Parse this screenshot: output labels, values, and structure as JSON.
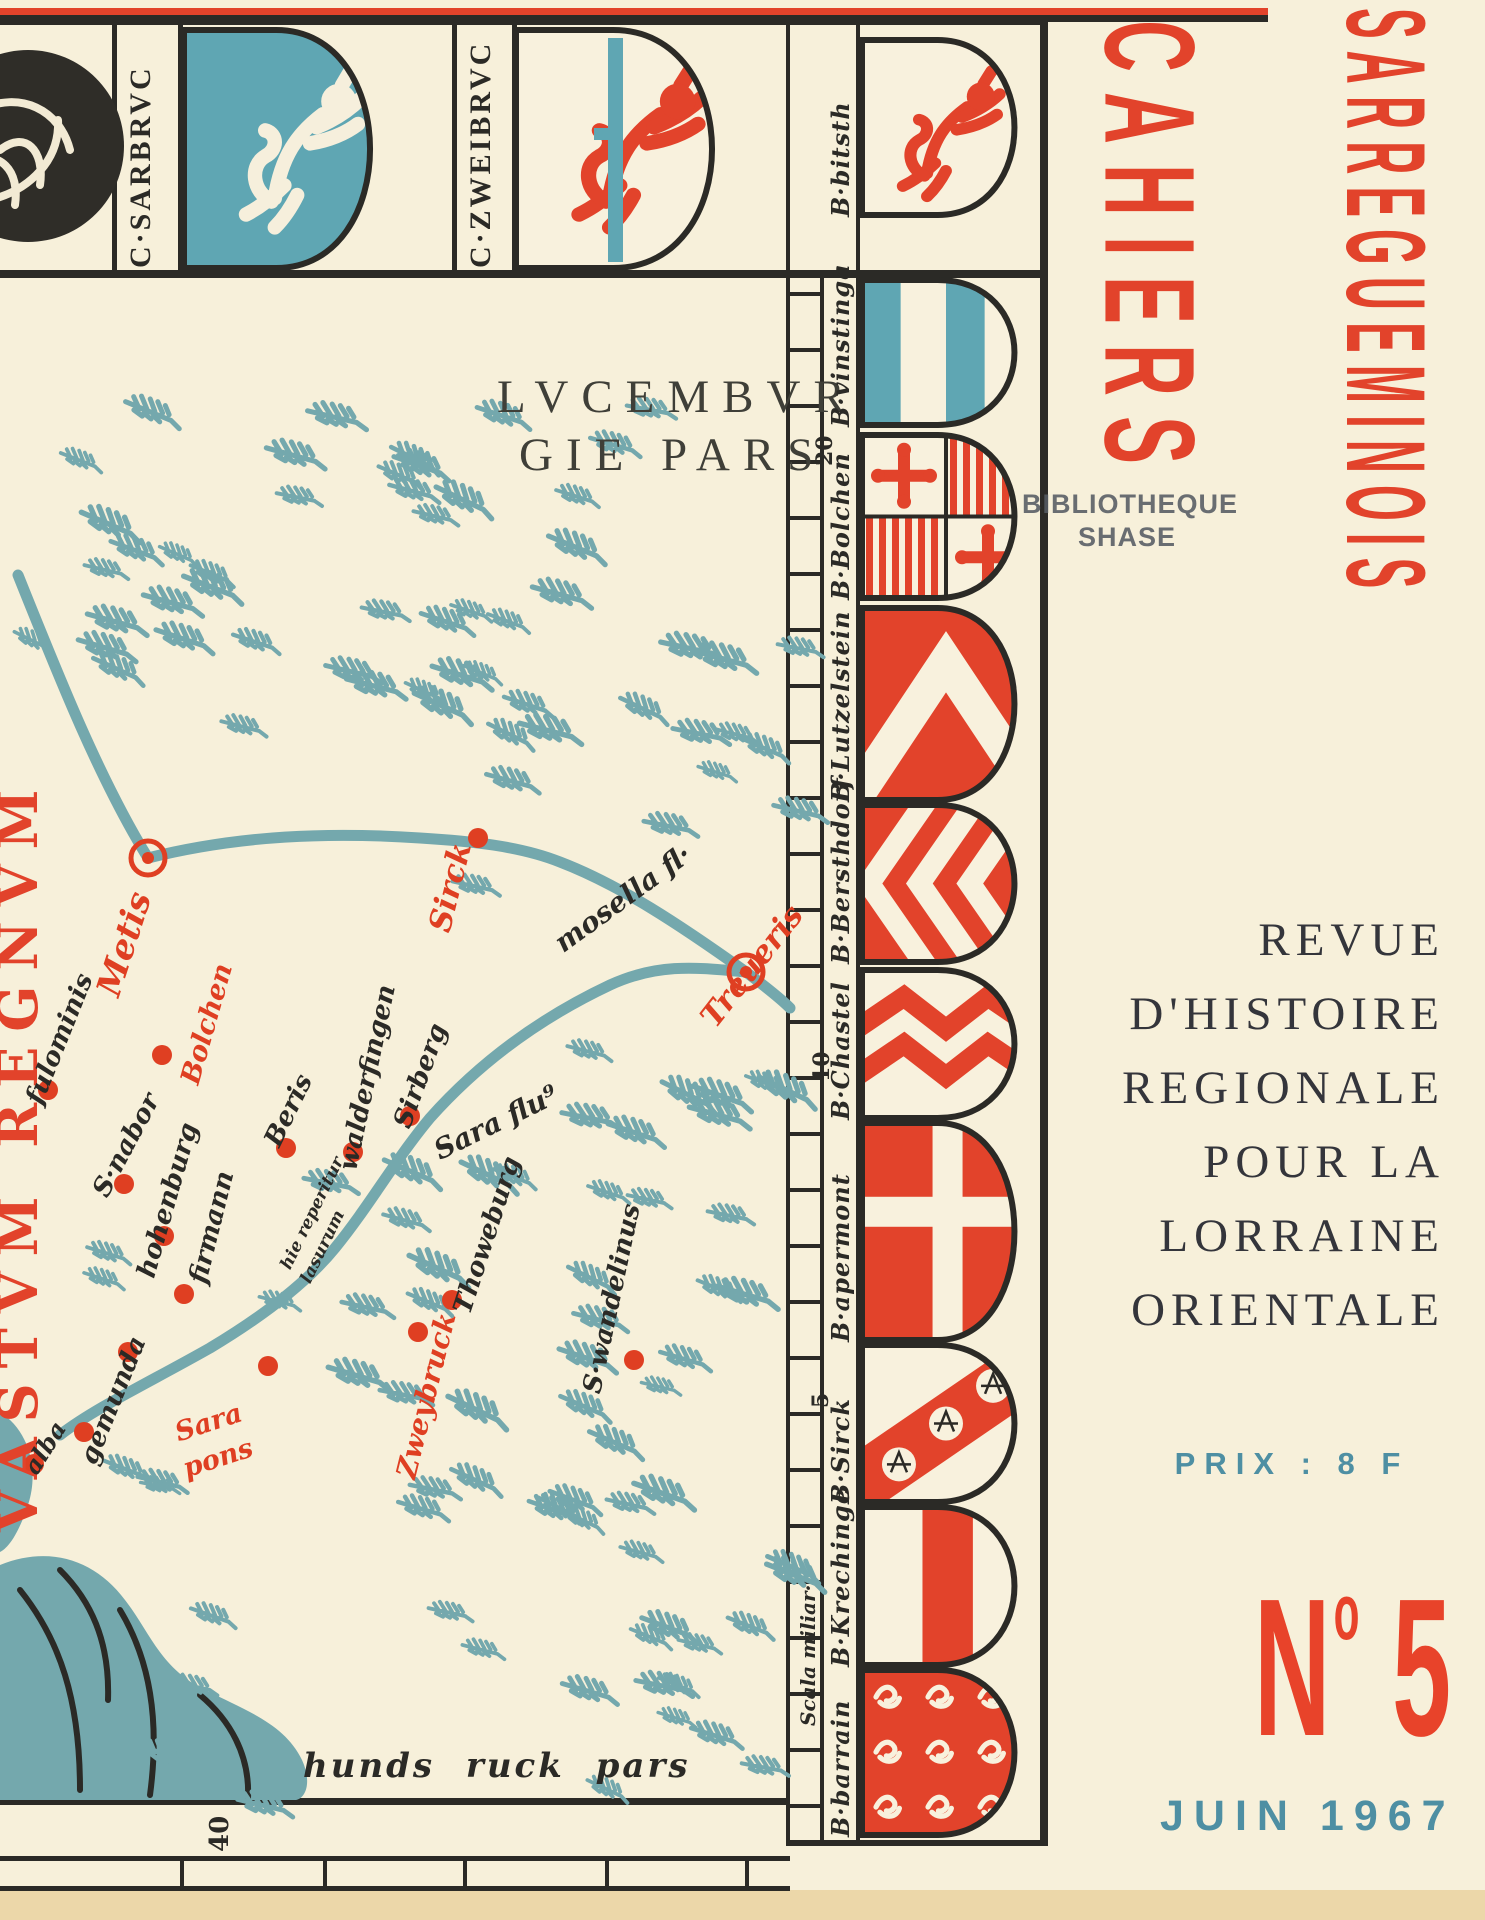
{
  "page": {
    "width": 1485,
    "height": 1920,
    "background": "#f7f0da",
    "bottom_edge_color": "#ecd7a9"
  },
  "colors": {
    "red": "#e2432b",
    "map_red": "#df3f22",
    "teal": "#74a8ad",
    "shield_teal": "#5fa6b3",
    "ink": "#2b2a26",
    "teal_text": "#4e8fa3",
    "subtitle_ink": "#34353b",
    "stamp_gray": "#565b63"
  },
  "masthead": {
    "line1": "CAHIERS",
    "line2": "SARREGUEMINOIS"
  },
  "stamp": {
    "line1": "BIBLIOTHEQUE",
    "line2": "SHASE"
  },
  "subtitle": {
    "lines": [
      "REVUE",
      "D'HISTOIRE",
      "REGIONALE",
      "POUR LA",
      "LORRAINE",
      "ORIENTALE"
    ]
  },
  "price": {
    "label": "PRIX : 8 F"
  },
  "issue": {
    "prefix": "N",
    "sup": "o",
    "number": " 5"
  },
  "date": {
    "label": "JUIN 1967"
  },
  "top_band": {
    "labels": [
      {
        "text": "C·SARBRVC",
        "x": 124,
        "y": 268
      },
      {
        "text": "C·ZWEIBRVC",
        "x": 464,
        "y": 268
      }
    ],
    "shields": [
      {
        "name": "medallion-eagle"
      },
      {
        "name": "lion-white-on-teal"
      },
      {
        "name": "lion-red-with-crozier"
      }
    ]
  },
  "strip": {
    "scale_caption": "Scala miliar·",
    "shields": [
      {
        "label": "B·bitsth",
        "pattern": "lion-red",
        "y0": 40,
        "y1": 215
      },
      {
        "label": "B·vinstinga",
        "pattern": "paly-teal",
        "y0": 280,
        "y1": 425
      },
      {
        "label": "B·Bolchen",
        "pattern": "quartered-crosses",
        "y0": 435,
        "y1": 598
      },
      {
        "label": "B·Lutzelstein",
        "pattern": "chevron-white-on-red",
        "y0": 608,
        "y1": 800
      },
      {
        "label": "B·Bersthdorf",
        "pattern": "chevrons-sideways",
        "y0": 805,
        "y1": 962
      },
      {
        "label": "B·Chastel",
        "pattern": "dancetty-red",
        "y0": 970,
        "y1": 1118
      },
      {
        "label": "B·apermont",
        "pattern": "cross-white-on-red",
        "y0": 1123,
        "y1": 1340
      },
      {
        "label": "B·Sirck",
        "pattern": "bend-scallops",
        "y0": 1345,
        "y1": 1502
      },
      {
        "label": "B·Krechinge",
        "pattern": "pale-red",
        "y0": 1507,
        "y1": 1665
      },
      {
        "label": "B·barrain",
        "pattern": "semy-lions",
        "y0": 1670,
        "y1": 1835
      }
    ]
  },
  "map": {
    "region_title": {
      "line1": "LVCEMBVR",
      "line2": "GIE PARS"
    },
    "edge_title": "VASTVM REGNVM",
    "bottom_caption": "hunds ruck pars",
    "labels": [
      {
        "text": "Metis",
        "x": 108,
        "y": 978,
        "rot": -72,
        "color": "red",
        "size": 34
      },
      {
        "text": "Bolchen",
        "x": 190,
        "y": 1070,
        "rot": -74,
        "color": "red",
        "size": 27
      },
      {
        "text": "fulominis",
        "x": 34,
        "y": 1090,
        "rot": -68,
        "color": "ink",
        "size": 26
      },
      {
        "text": "S·nabor",
        "x": 100,
        "y": 1182,
        "rot": -62,
        "color": "ink",
        "size": 26
      },
      {
        "text": "hohenburg",
        "x": 146,
        "y": 1264,
        "rot": -74,
        "color": "ink",
        "size": 26
      },
      {
        "text": "firmann",
        "x": 198,
        "y": 1270,
        "rot": -76,
        "color": "ink",
        "size": 26
      },
      {
        "text": "Beris",
        "x": 272,
        "y": 1132,
        "rot": -64,
        "color": "ink",
        "size": 26
      },
      {
        "text": "walderfingen",
        "x": 348,
        "y": 1157,
        "rot": -78,
        "color": "ink",
        "size": 26
      },
      {
        "text": "Sirberg",
        "x": 402,
        "y": 1114,
        "rot": -70,
        "color": "ink",
        "size": 26
      },
      {
        "text": "hie reperitur",
        "x": 286,
        "y": 1260,
        "rot": -64,
        "color": "ink",
        "size": 17
      },
      {
        "text": "lasurum",
        "x": 306,
        "y": 1274,
        "rot": -64,
        "color": "ink",
        "size": 17
      },
      {
        "text": "Sara flu⁹",
        "x": 436,
        "y": 1138,
        "rot": -26,
        "color": "ink",
        "size": 28
      },
      {
        "text": "mosella fl·",
        "x": 558,
        "y": 932,
        "rot": -36,
        "color": "ink",
        "size": 28
      },
      {
        "text": "Sirck",
        "x": 440,
        "y": 916,
        "rot": -76,
        "color": "red",
        "size": 31
      },
      {
        "text": "Treueris",
        "x": 708,
        "y": 1008,
        "rot": -52,
        "color": "red",
        "size": 31
      },
      {
        "text": "Thoweburg",
        "x": 462,
        "y": 1300,
        "rot": -72,
        "color": "ink",
        "size": 26
      },
      {
        "text": "S·wandelinus",
        "x": 592,
        "y": 1380,
        "rot": -78,
        "color": "ink",
        "size": 26
      },
      {
        "text": "Zweybruck",
        "x": 406,
        "y": 1464,
        "rot": -76,
        "color": "red",
        "size": 28
      },
      {
        "text": "Sara",
        "x": 176,
        "y": 1420,
        "rot": -18,
        "color": "red",
        "size": 27
      },
      {
        "text": "pons",
        "x": 184,
        "y": 1456,
        "rot": -18,
        "color": "red",
        "size": 27
      },
      {
        "text": "gemunda",
        "x": 88,
        "y": 1450,
        "rot": -68,
        "color": "ink",
        "size": 26
      },
      {
        "text": "alba",
        "x": 30,
        "y": 1460,
        "rot": -58,
        "color": "ink",
        "size": 24
      }
    ],
    "dots": [
      [
        478,
        838
      ],
      [
        48,
        1090
      ],
      [
        124,
        1184
      ],
      [
        162,
        1055
      ],
      [
        164,
        1236
      ],
      [
        184,
        1294
      ],
      [
        286,
        1148
      ],
      [
        353,
        1152
      ],
      [
        410,
        1116
      ],
      [
        452,
        1300
      ],
      [
        634,
        1360
      ],
      [
        128,
        1352
      ],
      [
        268,
        1366
      ],
      [
        84,
        1432
      ],
      [
        34,
        1464
      ],
      [
        418,
        1332
      ]
    ],
    "double_rings": [
      [
        148,
        858
      ],
      [
        746,
        972
      ]
    ],
    "scale_numbers": [
      {
        "text": "40",
        "x": 205,
        "y": 1852
      },
      {
        "text": "20",
        "x": 812,
        "y": 466
      },
      {
        "text": "10",
        "x": 809,
        "y": 1082
      },
      {
        "text": "5",
        "x": 808,
        "y": 1408
      }
    ]
  }
}
